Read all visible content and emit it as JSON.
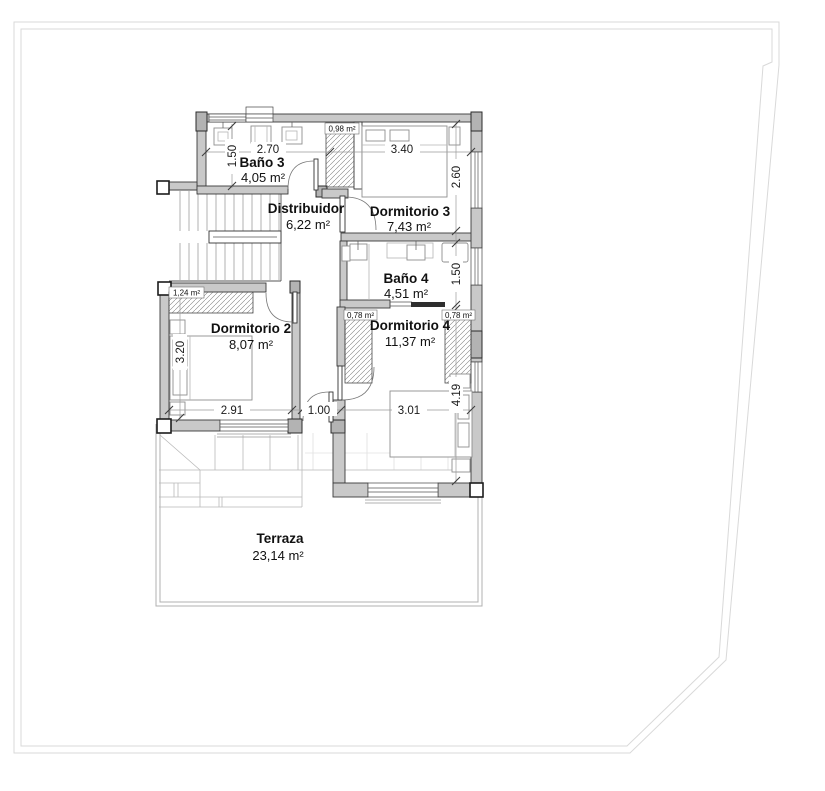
{
  "rooms": {
    "bano3": {
      "name": "Baño 3",
      "area": "4,05 m²"
    },
    "distribuidor": {
      "name": "Distribuidor",
      "area": "6,22 m²"
    },
    "dorm3": {
      "name": "Dormitorio 3",
      "area": "7,43 m²"
    },
    "bano4": {
      "name": "Baño 4",
      "area": "4,51 m²"
    },
    "dorm2": {
      "name": "Dormitorio 2",
      "area": "8,07 m²"
    },
    "dorm4": {
      "name": "Dormitorio 4",
      "area": "11,37 m²"
    },
    "terraza": {
      "name": "Terraza",
      "area": "23,14 m²"
    }
  },
  "closets": {
    "hall_closet": "0,98 m²",
    "dorm2_wardrobe": "1,24 m²",
    "dorm4_wardrobe_left": "0,78 m²",
    "dorm4_wardrobe_right": "0,78 m²"
  },
  "dimensions": {
    "bano3_width": "2.70",
    "bano3_depth": "1.50",
    "dorm3_width": "3.40",
    "dorm3_depth": "2.60",
    "bano4_depth": "1.50",
    "dorm2_depth": "3.20",
    "dorm2_width": "2.91",
    "passage_width": "1.00",
    "dorm4_width": "3.01",
    "dorm4_depth": "4.19"
  }
}
